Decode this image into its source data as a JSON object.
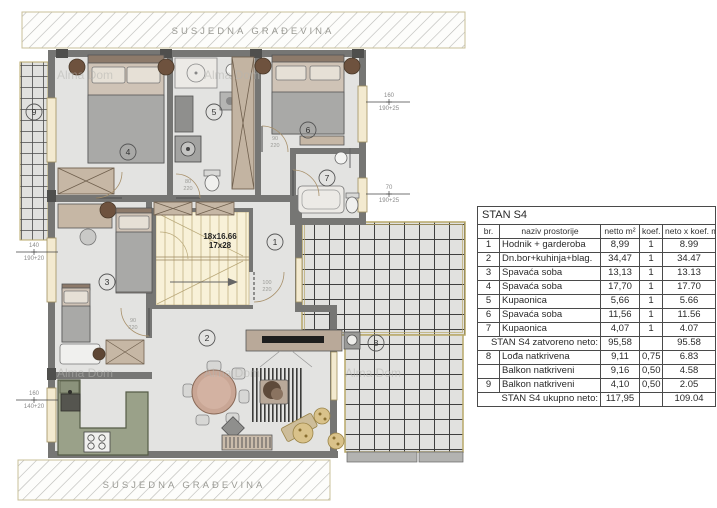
{
  "site": {
    "top_label": "SUSJEDNA GRAĐEVINA",
    "bottom_label": "SUSJEDNA GRAĐEVINA"
  },
  "watermark": {
    "text": "Alma Dom"
  },
  "plan": {
    "stairs": {
      "line1": "18x16.66",
      "line2": "17x28"
    },
    "rooms": [
      {
        "num": "1"
      },
      {
        "num": "2"
      },
      {
        "num": "3"
      },
      {
        "num": "4"
      },
      {
        "num": "5"
      },
      {
        "num": "6"
      },
      {
        "num": "7"
      },
      {
        "num": "8"
      },
      {
        "num": "9"
      }
    ],
    "window_dims": [
      {
        "main": "160",
        "sub": "190+25"
      },
      {
        "main": "70",
        "sub": "190+25"
      },
      {
        "main": "140",
        "sub": "190+20"
      },
      {
        "main": "160",
        "sub": "140+20"
      }
    ],
    "door_dims": [
      {
        "main": "100",
        "sub": "220"
      },
      {
        "main": "90",
        "sub": "220"
      },
      {
        "main": "80",
        "sub": "220"
      },
      {
        "main": "90",
        "sub": "220"
      }
    ]
  },
  "table": {
    "title": "STAN S4",
    "headers": [
      "br.",
      "naziv prostorije",
      "netto m²",
      "koef.",
      "neto x koef. m²"
    ],
    "rows": [
      {
        "br": "1",
        "name": "Hodnik + garderoba",
        "netto": "8,99",
        "koef": "1",
        "total": "8.99"
      },
      {
        "br": "2",
        "name": "Dn.bor+kuhinja+blag.",
        "netto": "34,47",
        "koef": "1",
        "total": "34.47"
      },
      {
        "br": "3",
        "name": "Spavaća soba",
        "netto": "13,13",
        "koef": "1",
        "total": "13.13"
      },
      {
        "br": "4",
        "name": "Spavaća soba",
        "netto": "17,70",
        "koef": "1",
        "total": "17.70"
      },
      {
        "br": "5",
        "name": "Kupaonica",
        "netto": "5,66",
        "koef": "1",
        "total": "5.66"
      },
      {
        "br": "6",
        "name": "Spavaća soba",
        "netto": "11,56",
        "koef": "1",
        "total": "11.56"
      },
      {
        "br": "7",
        "name": "Kupaonica",
        "netto": "4,07",
        "koef": "1",
        "total": "4.07"
      },
      {
        "br": "8",
        "name": "Lođa natkrivena",
        "netto": "9,11",
        "koef": "0,75",
        "total": "6.83"
      },
      {
        "br": "",
        "name": "Balkon natkriveni",
        "netto": "9,16",
        "koef": "0,50",
        "total": "4.58"
      },
      {
        "br": "9",
        "name": "Balkon natkriveni",
        "netto": "4,10",
        "koef": "0,50",
        "total": "2.05"
      }
    ],
    "subtotal": {
      "label": "STAN S4 zatvoreno neto:",
      "netto": "95,58",
      "total": "95.58"
    },
    "grand_total": {
      "label": "STAN S4 ukupno neto:",
      "netto": "117,95",
      "total": "109.04"
    }
  },
  "colors": {
    "wall": "#767674",
    "floor": "#e3e3e1",
    "kitchen": "#9aa189",
    "tile_border": "#b8a868",
    "stairs": "#f8f1d8"
  }
}
